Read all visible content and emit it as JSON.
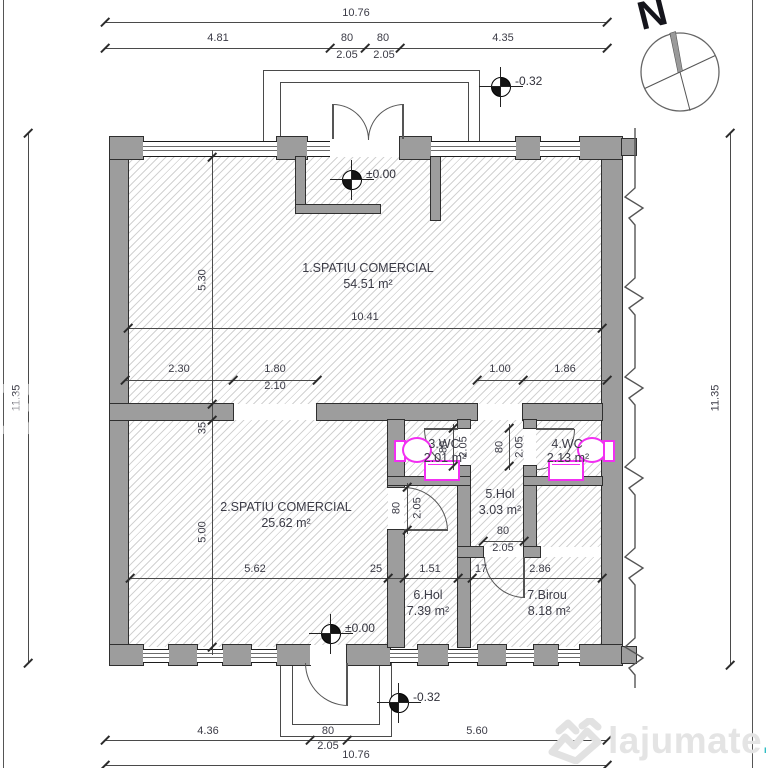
{
  "plan": {
    "rooms": [
      {
        "name": "1.SPATIU COMERCIAL",
        "area": "54.51 m²"
      },
      {
        "name": "2.SPATIU COMERCIAL",
        "area": "25.62 m²"
      },
      {
        "name": "3.WC",
        "area": "2.01 m²"
      },
      {
        "name": "4.WC",
        "area": "2.13 m²"
      },
      {
        "name": "5.Hol",
        "area": "3.03 m²"
      },
      {
        "name": "6.Hol",
        "area": "7.39 m²"
      },
      {
        "name": "7.Birou",
        "area": "8.18 m²"
      }
    ],
    "dims": {
      "top_total": "10.76",
      "top_left": "4.81",
      "top_d1": "80",
      "top_d2": "80",
      "top_right": "4.35",
      "top_s1": "2.05",
      "top_s2": "2.05",
      "side_left": "11.35",
      "side_right": "11.35",
      "room1_w": "10.41",
      "room1_h": "5.30",
      "room2_h": "5.00",
      "wall_t": "35",
      "mid_1": "2.30",
      "mid_2": "1.80",
      "mid_2b": "2.10",
      "mid_3": "1.00",
      "mid_4": "1.86",
      "low_1": "5.62",
      "low_2": "25",
      "low_3": "1.51",
      "low_4": "17",
      "low_5": "2.86",
      "door_w": "80",
      "door_h": "2.05",
      "bot_left": "4.36",
      "bot_d": "80",
      "bot_s": "2.05",
      "bot_right": "5.60",
      "bot_total": "10.76"
    },
    "levels": {
      "zero": "±0.00",
      "minus": "-0.32"
    },
    "compass": {
      "north": "N"
    },
    "watermark": {
      "name": "lajumate",
      "tld": ".ro"
    }
  }
}
